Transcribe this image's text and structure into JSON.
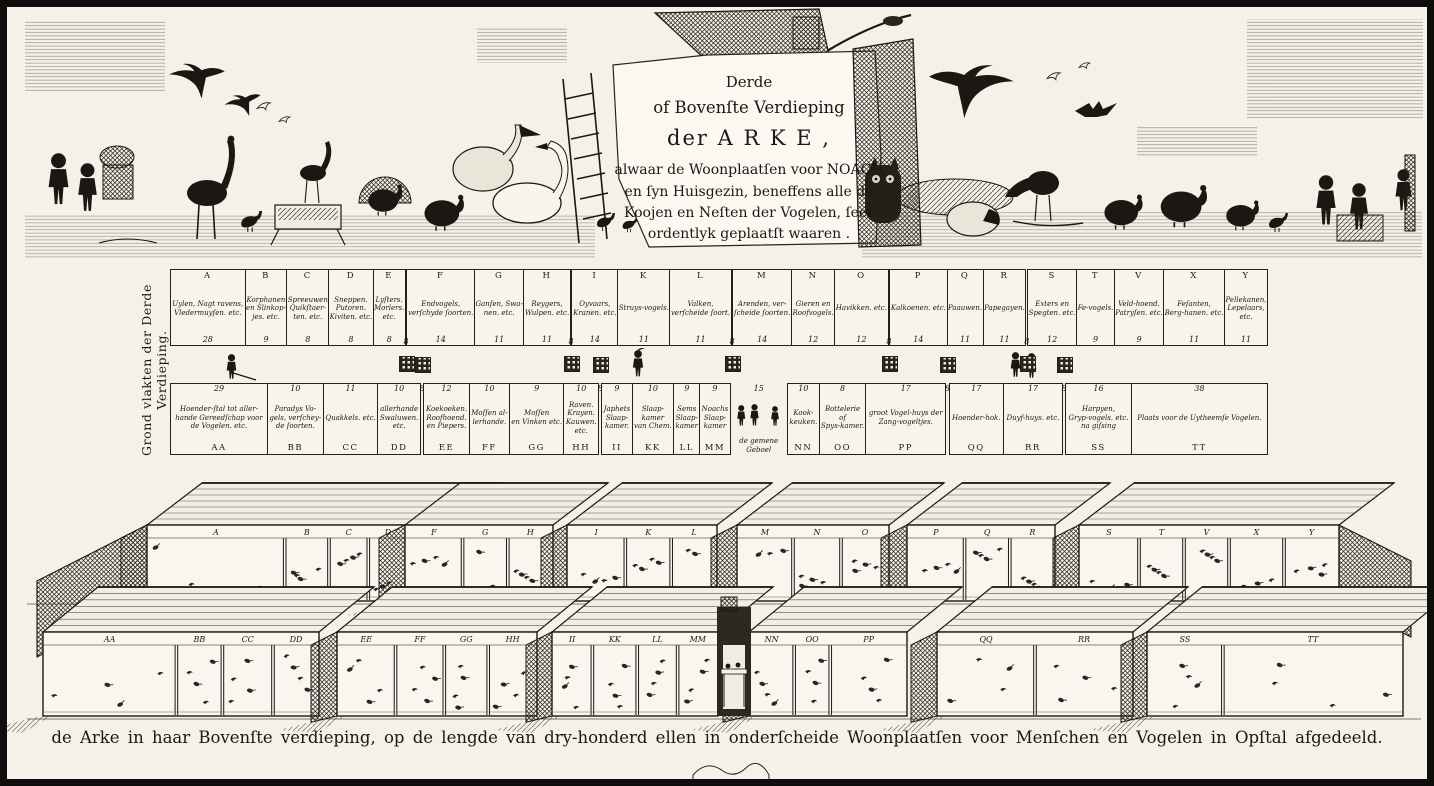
{
  "ink": "#1c1712",
  "paper": "#f4f1e8",
  "title": {
    "lines": [
      "Derde",
      "of Bovenſte Verdieping",
      "der A R K E ,",
      "alwaar de Woonplaatſen voor NOACH",
      "en ſyn Huisgezin, beneffens alle de",
      "Koojen en Neſten der Vogelen, ſeer",
      "ordentlyk geplaatſt waaren ."
    ]
  },
  "side_label": "Grond vlakten der Derde Verdieping.",
  "caption": "de Arke in haar Bovenſte verdieping, op de lengde van dry-honderd ellen in onderſcheide Woonplaatſen voor Menſchen en Vogelen in Opſtal afgedeeld.",
  "plan": {
    "top_row": [
      {
        "cells": [
          {
            "letter": "A",
            "label": "Uylen, Nagt ravens,\nVledermuyſen. etc.",
            "n": 28
          },
          {
            "letter": "B",
            "label": "Korphanen\nen Slinkop-\njes. etc.",
            "n": 9
          },
          {
            "letter": "C",
            "label": "Spreeuwen\nQuikſtaer-\nten. etc.",
            "n": 8
          },
          {
            "letter": "D",
            "label": "Sneppen.\nPutoren.\nKiviten. etc.",
            "n": 8
          },
          {
            "letter": "E",
            "label": "Lyſters.\nMorlers.\netc.",
            "n": 8
          }
        ]
      },
      {
        "gap": 8
      },
      {
        "cells": [
          {
            "letter": "F",
            "label": "Endvogels,\nverſchyde ſoorten.",
            "n": 14
          },
          {
            "letter": "G",
            "label": "Ganſen, Swa-\nnen. etc.",
            "n": 11
          },
          {
            "letter": "H",
            "label": "Reygers,\nWulpen. etc.",
            "n": 11
          }
        ]
      },
      {
        "gap": 8
      },
      {
        "cells": [
          {
            "letter": "I",
            "label": "Oyvaars,\nKranen. etc.",
            "n": 14
          },
          {
            "letter": "K",
            "label": "Struys-vogels.",
            "n": 11
          },
          {
            "letter": "L",
            "label": "Valken,\nverſcheide ſoort.",
            "n": 11
          }
        ]
      },
      {
        "gap": 8
      },
      {
        "cells": [
          {
            "letter": "M",
            "label": "Arenden, ver-\nſcheide ſoorten.",
            "n": 14
          },
          {
            "letter": "N",
            "label": "Gieren en\nRoofvogels.",
            "n": 12
          },
          {
            "letter": "O",
            "label": "Havikken. etc.",
            "n": 12
          }
        ]
      },
      {
        "gap": 8
      },
      {
        "cells": [
          {
            "letter": "P",
            "label": "Kalkoenen. etc.",
            "n": 14
          },
          {
            "letter": "Q",
            "label": "Paauwen.",
            "n": 11
          },
          {
            "letter": "R",
            "label": "Papegayen.",
            "n": 11
          }
        ]
      },
      {
        "gap": 8
      },
      {
        "cells": [
          {
            "letter": "S",
            "label": "Exters en\nSpegten. etc.",
            "n": 12
          },
          {
            "letter": "T",
            "label": "Fe-vogels.",
            "n": 9
          },
          {
            "letter": "V",
            "label": "Veld-hoend.\nPatryſen. etc.",
            "n": 9
          },
          {
            "letter": "X",
            "label": "Feſanten,\nBerg-hanen. etc.",
            "n": 11
          },
          {
            "letter": "Y",
            "label": "Pellekanen,\nLepelaars,\netc.",
            "n": 11
          }
        ]
      }
    ],
    "bottom_row": [
      {
        "cells": [
          {
            "letter": "AA",
            "label": "Hoender-ſtal tot aller-\nhande Gereedſchap voor\nde Vogelen. etc.",
            "n": 29
          },
          {
            "letter": "BB",
            "label": "Paradys Vo-\ngels, verſchey-\nde ſoorten.",
            "n": 10
          },
          {
            "letter": "CC",
            "label": "Quakkels. etc.",
            "n": 11
          },
          {
            "letter": "DD",
            "label": "allerhande\nSwaluwen.\netc.",
            "n": 10
          }
        ]
      },
      {
        "gap": 8
      },
      {
        "cells": [
          {
            "letter": "EE",
            "label": "Koekoeken.\nRoofhoend.\nen Piepers.",
            "n": 12
          },
          {
            "letter": "FF",
            "label": "Moſſen al-\nlerhande.",
            "n": 10
          },
          {
            "letter": "GG",
            "label": "Moſſen\nen Vinken etc.",
            "n": 9
          },
          {
            "letter": "HH",
            "label": "Raven.\nKrayen.\nKauwen.\netc.",
            "n": 10
          }
        ]
      },
      {
        "gap": 8
      },
      {
        "cells": [
          {
            "letter": "II",
            "label": "Japhets\nSlaap-\nkamer.",
            "n": 9
          },
          {
            "letter": "KK",
            "label": "Slaap-\nkamer\nvan Chem.",
            "n": 10
          },
          {
            "letter": "LL",
            "label": "Sems\nSlaap-\nkamer",
            "n": 9
          },
          {
            "letter": "MM",
            "label": "Noachs\nSlaap-\nkamer",
            "n": 9
          }
        ]
      },
      {
        "scene": {
          "n": 15,
          "label": "de gemene\nGeboel"
        }
      },
      {
        "cells": [
          {
            "letter": "NN",
            "label": "Kook-\nkeuken.",
            "n": 10
          },
          {
            "letter": "OO",
            "label": "Bottelerie\nof\nSpys-kamer.",
            "n": 8
          },
          {
            "letter": "PP",
            "label": "groot Vogel-huys der\nZang-vogeltjes.",
            "n": 17
          }
        ]
      },
      {
        "gap": 8
      },
      {
        "cells": [
          {
            "letter": "QQ",
            "label": "Hoender-hok.",
            "n": 17
          },
          {
            "letter": "RR",
            "label": "Duyf-huys. etc.",
            "n": 17
          }
        ]
      },
      {
        "gap": 8
      },
      {
        "cells": [
          {
            "letter": "SS",
            "label": "Harpyen,\nGryp-vogels. etc.\nna giſsing",
            "n": 16
          },
          {
            "letter": "TT",
            "label": "Plaats voor de Uytheemſe Vogelen.",
            "n": 38
          }
        ]
      }
    ]
  },
  "perspective": {
    "top_sheds": [
      {
        "letters": [
          "A",
          "B",
          "C",
          "D",
          "E"
        ],
        "w": [
          28,
          9,
          8,
          8,
          8
        ]
      },
      {
        "letters": [
          "F",
          "G",
          "H"
        ],
        "w": [
          14,
          11,
          11
        ]
      },
      {
        "letters": [
          "I",
          "K",
          "L"
        ],
        "w": [
          14,
          11,
          11
        ]
      },
      {
        "letters": [
          "M",
          "N",
          "O"
        ],
        "w": [
          14,
          12,
          12
        ]
      },
      {
        "letters": [
          "P",
          "Q",
          "R"
        ],
        "w": [
          14,
          11,
          11
        ]
      },
      {
        "letters": [
          "S",
          "T",
          "V",
          "X",
          "Y"
        ],
        "w": [
          12,
          9,
          9,
          11,
          11
        ]
      }
    ],
    "bottom_sheds": [
      {
        "letters": [
          "AA",
          "BB",
          "CC",
          "DD"
        ],
        "w": [
          29,
          10,
          11,
          10
        ]
      },
      {
        "letters": [
          "EE",
          "FF",
          "GG",
          "HH"
        ],
        "w": [
          12,
          10,
          9,
          10
        ]
      },
      {
        "letters": [
          "II",
          "KK",
          "LL",
          "MM"
        ],
        "w": [
          9,
          10,
          9,
          9
        ]
      },
      {
        "letters": [
          "NN",
          "OO",
          "PP"
        ],
        "w": [
          10,
          8,
          17
        ]
      },
      {
        "letters": [
          "QQ",
          "RR"
        ],
        "w": [
          17,
          17
        ]
      },
      {
        "letters": [
          "SS",
          "TT"
        ],
        "w": [
          16,
          38
        ]
      }
    ]
  }
}
